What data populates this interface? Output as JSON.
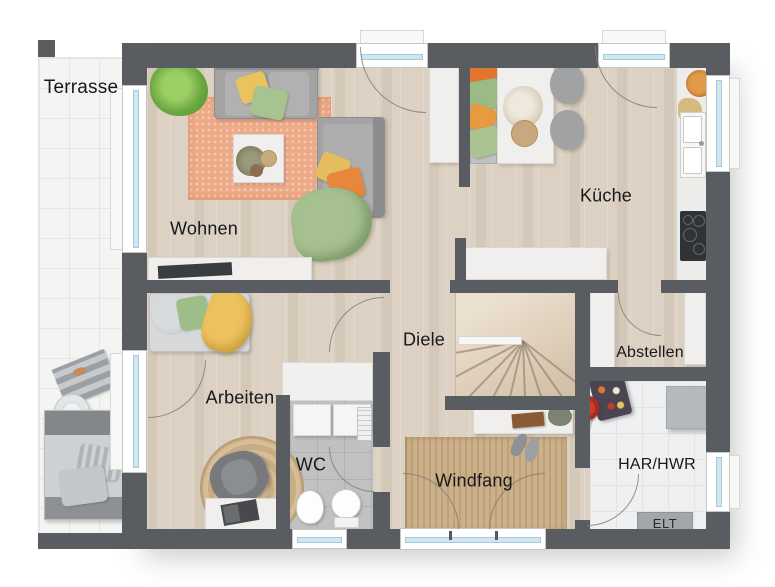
{
  "image_type": "architectural-floor-plan",
  "rooms": [
    {
      "id": "terrasse",
      "label": "Terrasse"
    },
    {
      "id": "wohnen",
      "label": "Wohnen"
    },
    {
      "id": "kueche",
      "label": "Küche"
    },
    {
      "id": "diele",
      "label": "Diele"
    },
    {
      "id": "arbeiten",
      "label": "Arbeiten"
    },
    {
      "id": "wc",
      "label": "WC"
    },
    {
      "id": "windfang",
      "label": "Windfang"
    },
    {
      "id": "abstellen",
      "label": "Abstellen"
    },
    {
      "id": "har_hwr",
      "label": "HAR/HWR"
    }
  ],
  "annotations": {
    "elt_label": "ELT"
  },
  "colors": {
    "wall": "#595d62",
    "floor_wood": "#dcd1c3",
    "terrace_tile": "#f4f4f3",
    "wc_tile": "#bfc1c3",
    "har_tile": "#eff0f1",
    "window_glass": "#cfe7f3",
    "rug_living": "#edaa86",
    "rug_jute": "#ccb089",
    "accent_orange": "#e2762e",
    "accent_yellow": "#e8c35e",
    "accent_green": "#a3bf8d",
    "plant_green": "#6aa83f",
    "sofa_gray": "#a3a3a4",
    "elt_box": "#a4a7aa",
    "label_text": "#17181a"
  },
  "furniture": [
    "sofa",
    "chaise-longue",
    "coffee-table",
    "living-rug",
    "sideboard",
    "tv",
    "potted-plant",
    "tall-cabinet",
    "dining-bench",
    "dining-table",
    "dining-chairs",
    "kitchen-counter",
    "kitchen-sink",
    "cooktop",
    "fruit-bowl",
    "kitchen-island",
    "staircase",
    "daybed",
    "round-rug",
    "office-chair",
    "desk",
    "laptop",
    "wc-vanity",
    "washbasin",
    "toilet",
    "radiator",
    "entry-rug",
    "console-shelf",
    "shoes",
    "storage-cabinets",
    "laundry-basket",
    "vacuum-cleaner",
    "storage-box",
    "electrical-panel",
    "sun-lounger",
    "side-table",
    "towel"
  ]
}
